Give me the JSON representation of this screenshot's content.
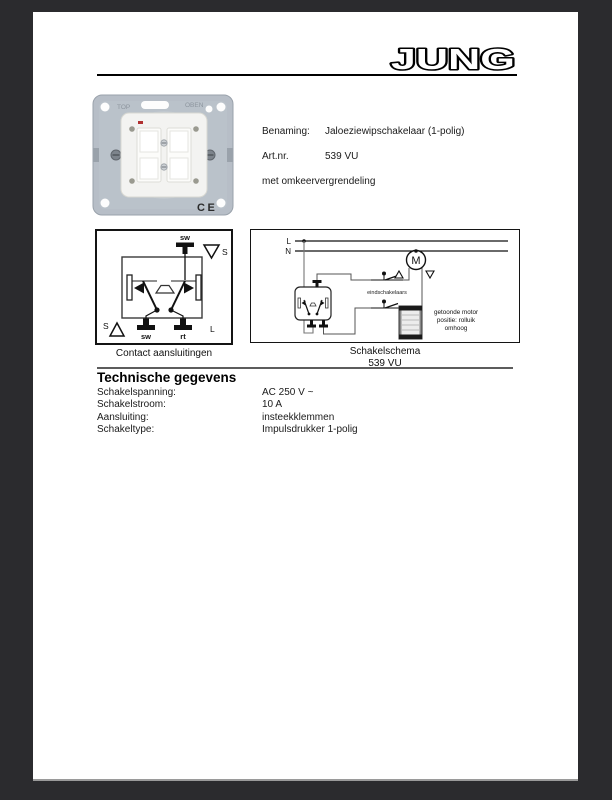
{
  "brand": {
    "logo_text": "JUNG"
  },
  "product_info": {
    "rows": [
      {
        "label": "Benaming:",
        "value": "Jaloeziewipschakelaar (1-polig)"
      },
      {
        "label": "Art.nr.",
        "value": "539 VU"
      }
    ],
    "note": "met omkeervergrendeling"
  },
  "photo": {
    "stamp_left": "TOP",
    "stamp_right": "OBEN",
    "ce_mark": "CE"
  },
  "contact_diagram": {
    "caption": "Contact aansluitingen",
    "labels": {
      "top_terminal": "sw",
      "s_top": "S",
      "s_bottom": "S",
      "bottom_left": "sw",
      "bottom_right": "rt",
      "line": "L"
    }
  },
  "schema_diagram": {
    "caption_line1": "Schakelschema",
    "caption_line2": "539 VU",
    "labels": {
      "phase": "L",
      "neutral": "N",
      "motor": "M",
      "limit_switches": "eindschakelaars"
    },
    "note_lines": [
      "getoonde motor",
      "positie: rolluik",
      "omhoog"
    ]
  },
  "tech": {
    "heading": "Technische gegevens",
    "rows": [
      {
        "label": "Schakelspanning:",
        "value": "AC 250 V ~"
      },
      {
        "label": "Schakelstroom:",
        "value": "10 A"
      },
      {
        "label": "Aansluiting:",
        "value": "insteekklemmen"
      },
      {
        "label": "Schakeltype:",
        "value": "Impulsdrukker 1-polig"
      }
    ]
  },
  "colors": {
    "background": "#2b2b2e",
    "paper": "#ffffff",
    "metal_plate": "#b7bec7",
    "diagram_border": "#141414"
  }
}
